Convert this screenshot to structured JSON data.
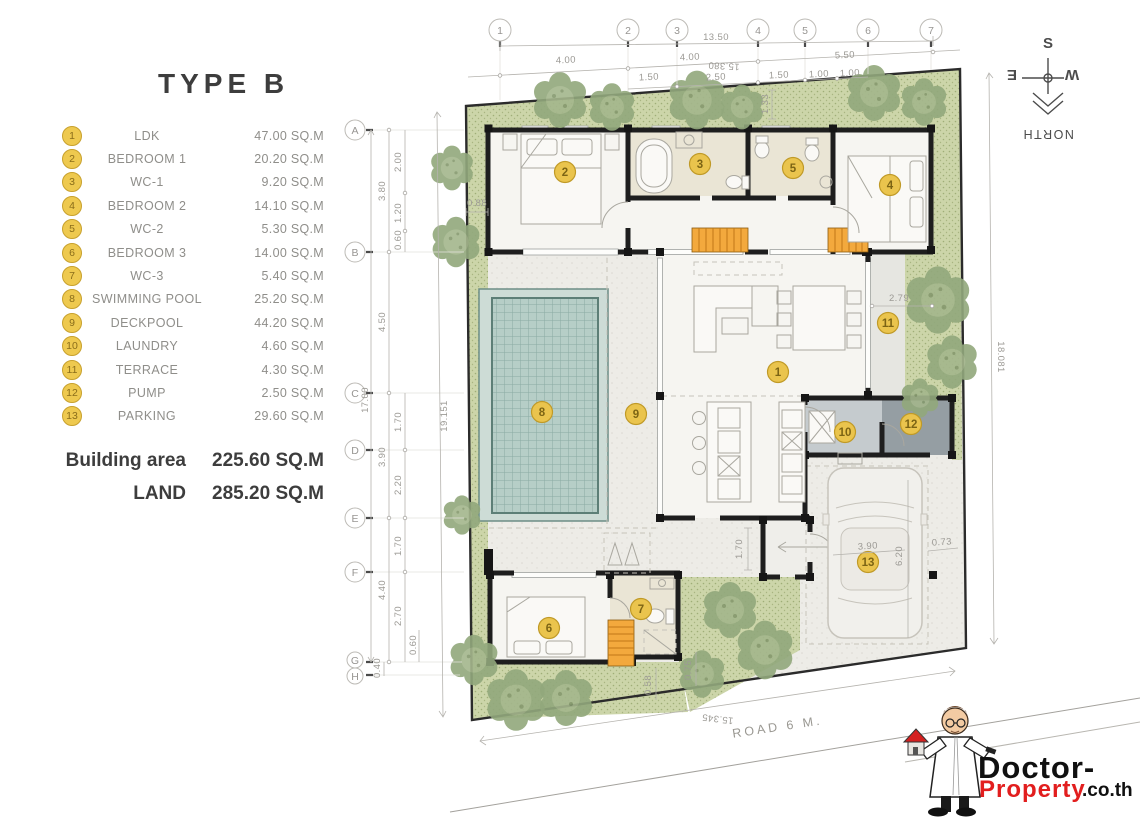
{
  "title": "TYPE B",
  "legend": {
    "items": [
      {
        "no": "1",
        "name": "LDK",
        "area": "47.00 SQ.M"
      },
      {
        "no": "2",
        "name": "BEDROOM 1",
        "area": "20.20 SQ.M"
      },
      {
        "no": "3",
        "name": "WC-1",
        "area": "9.20 SQ.M"
      },
      {
        "no": "4",
        "name": "BEDROOM 2",
        "area": "14.10 SQ.M"
      },
      {
        "no": "5",
        "name": "WC-2",
        "area": "5.30 SQ.M"
      },
      {
        "no": "6",
        "name": "BEDROOM 3",
        "area": "14.00 SQ.M"
      },
      {
        "no": "7",
        "name": "WC-3",
        "area": "5.40 SQ.M"
      },
      {
        "no": "8",
        "name": "SWIMMING POOL",
        "area": "25.20 SQ.M"
      },
      {
        "no": "9",
        "name": "DECKPOOL",
        "area": "44.20 SQ.M"
      },
      {
        "no": "10",
        "name": "LAUNDRY",
        "area": "4.60 SQ.M"
      },
      {
        "no": "11",
        "name": "TERRACE",
        "area": "4.30 SQ.M"
      },
      {
        "no": "12",
        "name": "PUMP",
        "area": "2.50 SQ.M"
      },
      {
        "no": "13",
        "name": "PARKING",
        "area": "29.60 SQ.M"
      }
    ]
  },
  "summary": {
    "building_area_label": "Building area",
    "building_area_value": "225.60 SQ.M",
    "land_label": "LAND",
    "land_value": "285.20 SQ.M"
  },
  "grid": {
    "cols": [
      "1",
      "2",
      "3",
      "4",
      "5",
      "6",
      "7"
    ],
    "rows": [
      "A",
      "B",
      "C",
      "D",
      "E",
      "F",
      "G",
      "H"
    ]
  },
  "markers": [
    "1",
    "2",
    "3",
    "4",
    "5",
    "6",
    "7",
    "8",
    "9",
    "10",
    "11",
    "12",
    "13"
  ],
  "dims": {
    "total_w": "13.50",
    "w1": "4.00",
    "w2": "4.00",
    "w3": "5.50",
    "bnd_top": "15.380",
    "s1": "1.50",
    "s2": "2.50",
    "s3": "1.50",
    "s4": "1.00",
    "s5": "1.00",
    "s6": "1.33",
    "v1": "2.00",
    "v2": "3.80",
    "v3": "1.20",
    "v4": "0.60",
    "v5": "4.50",
    "total_h": "17.00",
    "v6": "1.70",
    "v7": "3.90",
    "v8": "2.20",
    "v9": "1.70",
    "v10": "4.40",
    "v11": "2.70",
    "v12": "0.60",
    "v13": "0.40",
    "bnd_left": "19.151",
    "bnd_right": "18.081",
    "bnd_bottom": "15.345",
    "d088": "0.88",
    "d279": "2.79",
    "d170": "1.70",
    "d390": "3.90",
    "d620": "6.20",
    "d073": "0.73",
    "d058": "0.58",
    "d075": "0.75"
  },
  "compass": {
    "south": "S",
    "east": "E",
    "west": "W",
    "north": "NORTH"
  },
  "road": {
    "label": "ROAD 6 M."
  },
  "watermark": {
    "brand_top": "Doctor-",
    "brand_bottom": "Property",
    "brand_suffix": ".co.th"
  },
  "colors": {
    "marker_yellow": "#eac44d",
    "garden_green": "#ccd5a9",
    "pool_teal": "#b6cec7",
    "wall_black": "#1e1e1e",
    "brand_red": "#e21e1e"
  }
}
